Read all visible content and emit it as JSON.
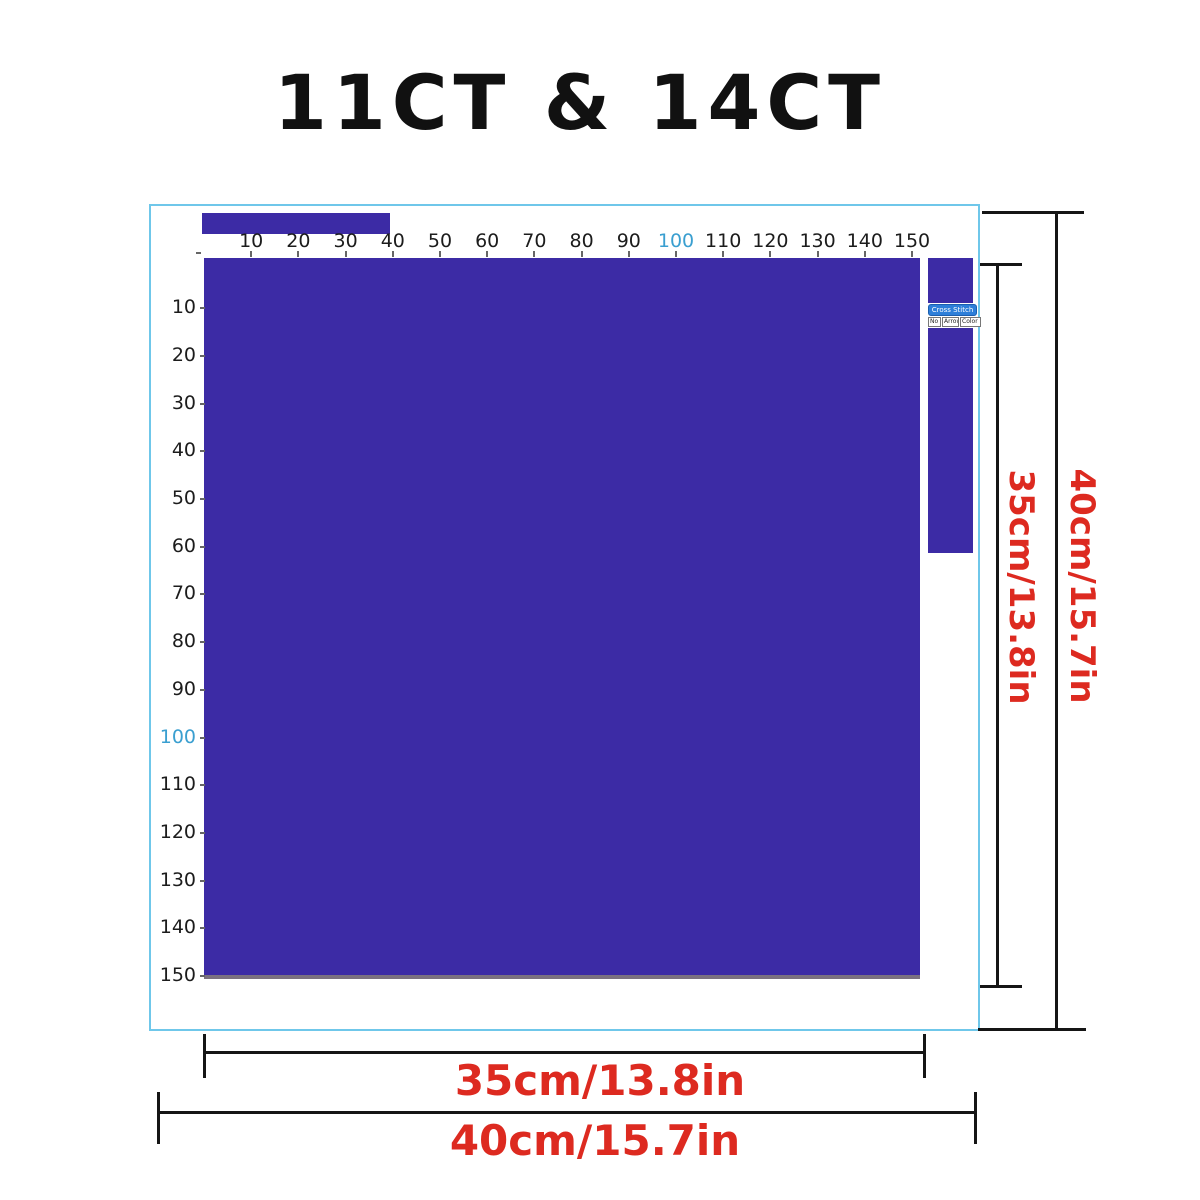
{
  "title": "11CT & 14CT",
  "fabric": {
    "color": "#3c2ba5",
    "box_border_color": "#6fc7ea",
    "bottom_edge_color": "#7b7180"
  },
  "rulers": {
    "top": {
      "labels": [
        "10",
        "20",
        "30",
        "40",
        "50",
        "60",
        "70",
        "80",
        "90",
        "100",
        "110",
        "120",
        "130",
        "140",
        "150"
      ],
      "highlight_label": "100",
      "highlight_color": "#3a9fd0"
    },
    "left": {
      "labels": [
        "10",
        "20",
        "30",
        "40",
        "50",
        "60",
        "70",
        "80",
        "90",
        "100",
        "110",
        "120",
        "130",
        "140",
        "150"
      ],
      "highlight_label": "100",
      "highlight_color": "#3a9fd0"
    }
  },
  "widget": {
    "title": "Cross Stitch",
    "buttons": [
      "No",
      "Arrow",
      "Color"
    ]
  },
  "dimensions": {
    "bottom_inner": "35cm/13.8in",
    "bottom_outer": "40cm/15.7in",
    "right_inner": "35cm/13.8in",
    "right_outer": "40cm/15.7in",
    "text_color": "#dd2a20"
  }
}
